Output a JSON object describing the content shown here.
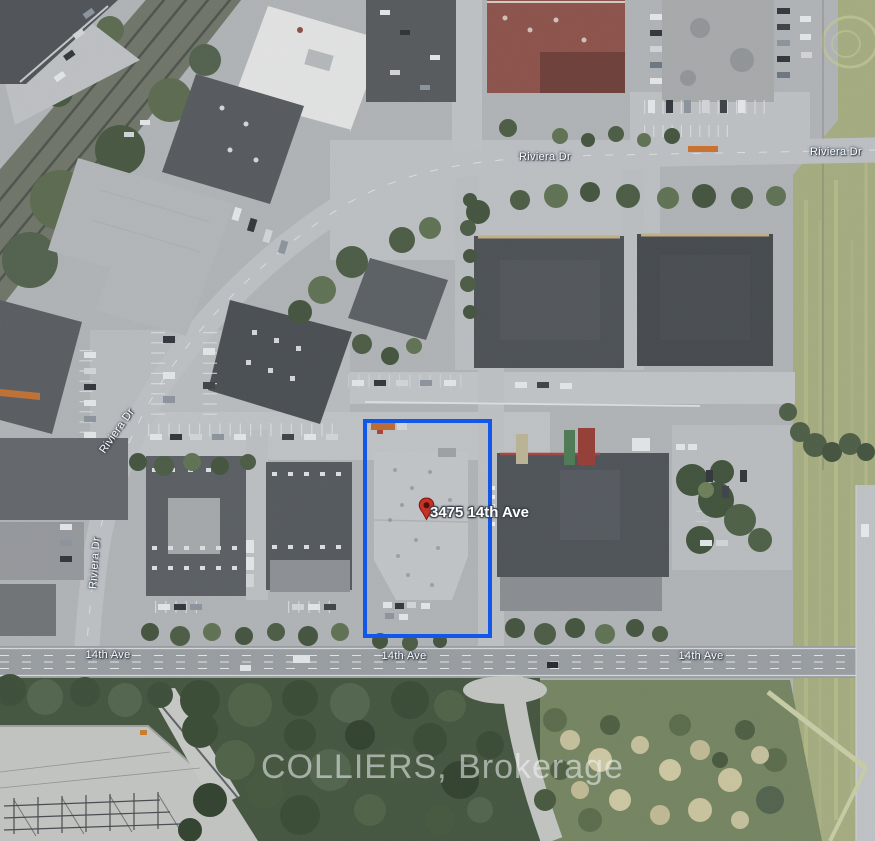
{
  "map": {
    "type": "satellite-aerial",
    "watermark": "COLLIERS, Brokerage",
    "pin": {
      "label": "3475 14th Ave",
      "color": "#c53226"
    },
    "highlight": {
      "color": "#1257e9"
    },
    "streets": {
      "riviera_1": "Riviera Dr",
      "riviera_2": "Riviera Dr",
      "riviera_3": "Riviera Dr",
      "riviera_4": "Riviera Dr",
      "ave14_1": "14th Ave",
      "ave14_2": "14th Ave",
      "ave14_3": "14th Ave"
    }
  }
}
